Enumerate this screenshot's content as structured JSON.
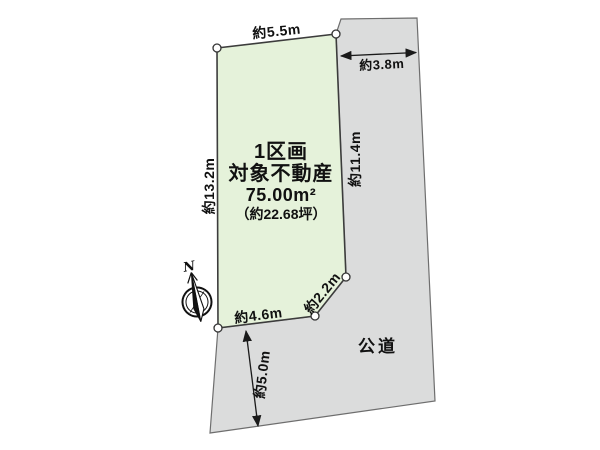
{
  "parcel": {
    "title": "1区画",
    "name": "対象不動産",
    "area_m2": "75.00m²",
    "area_tsubo": "（約22.68坪）"
  },
  "dimensions": {
    "top_edge": "約5.5m",
    "left_edge": "約13.2m",
    "right_edge": "約11.4m",
    "bottom_edge": "約4.6m",
    "corner_edge": "約2.2m",
    "road_width_upper": "約3.8m",
    "road_width_lower": "約5.0m"
  },
  "road": {
    "label": "公道"
  },
  "compass": {
    "north_label": "N"
  },
  "colors": {
    "parcel_fill": "#E5F2DA",
    "road_fill": "#DBDCDC",
    "parcel_outline": "#3C3C3C",
    "road_outline": "#6E6E6E",
    "dimension_ink": "#1A1A1A"
  }
}
